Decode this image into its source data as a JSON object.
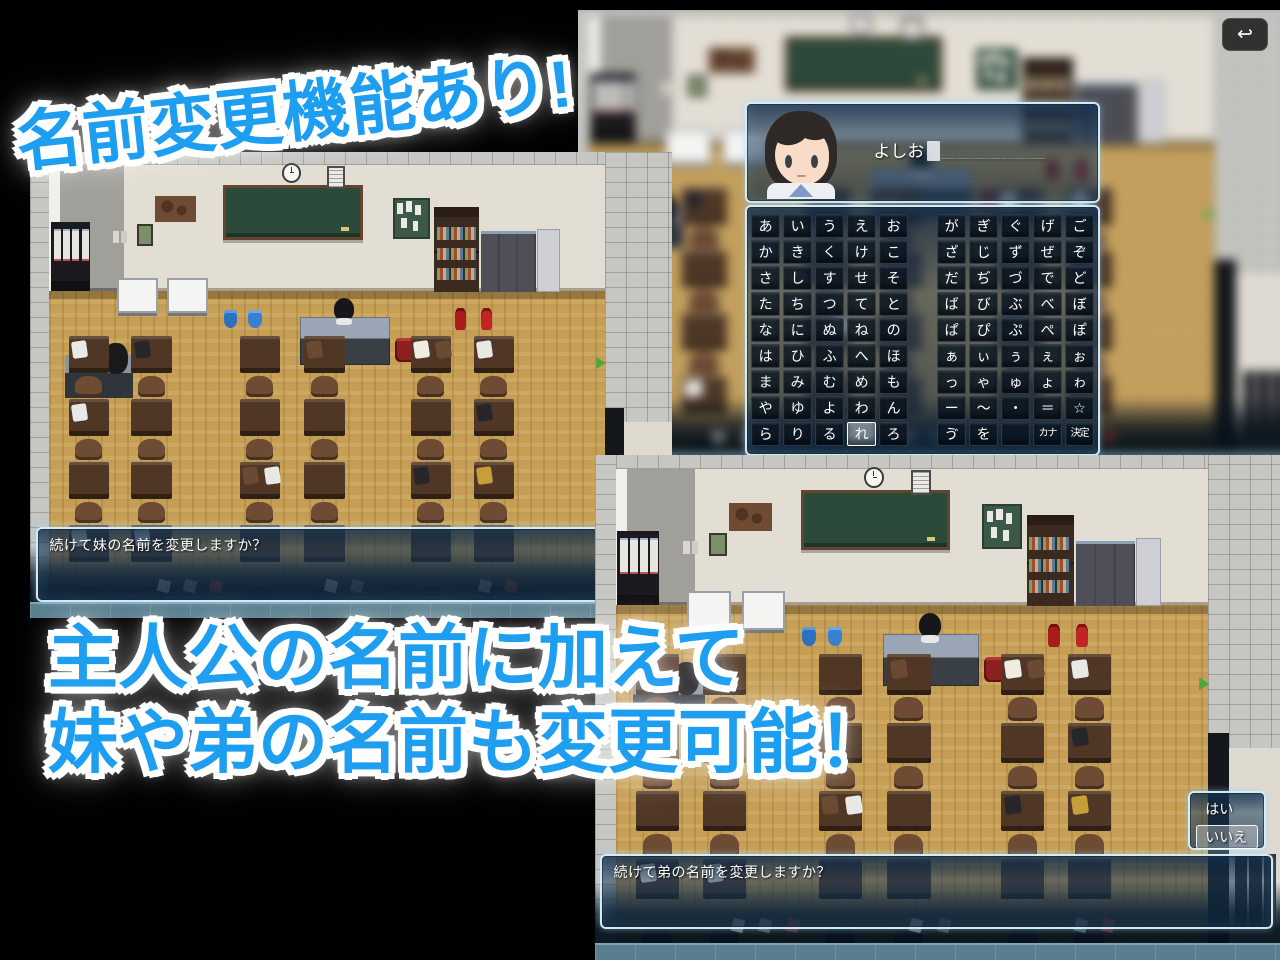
{
  "headlines": {
    "top": "名前変更機能あり!",
    "mid_line1": "主人公の名前に加えて",
    "mid_line2": "妹や弟の名前も変更可能！"
  },
  "name_input": {
    "value": "よしお",
    "empty_slots": "＿＿＿＿＿＿＿"
  },
  "keyboard": {
    "rows": [
      [
        "あ",
        "い",
        "う",
        "え",
        "お",
        "が",
        "ぎ",
        "ぐ",
        "げ",
        "ご"
      ],
      [
        "か",
        "き",
        "く",
        "け",
        "こ",
        "ざ",
        "じ",
        "ず",
        "ぜ",
        "ぞ"
      ],
      [
        "さ",
        "し",
        "す",
        "せ",
        "そ",
        "だ",
        "ぢ",
        "づ",
        "で",
        "ど"
      ],
      [
        "た",
        "ち",
        "つ",
        "て",
        "と",
        "ば",
        "び",
        "ぶ",
        "べ",
        "ぼ"
      ],
      [
        "な",
        "に",
        "ぬ",
        "ね",
        "の",
        "ぱ",
        "ぴ",
        "ぷ",
        "ぺ",
        "ぽ"
      ],
      [
        "は",
        "ひ",
        "ふ",
        "へ",
        "ほ",
        "ぁ",
        "ぃ",
        "ぅ",
        "ぇ",
        "ぉ"
      ],
      [
        "ま",
        "み",
        "む",
        "め",
        "も",
        "っ",
        "ゃ",
        "ゅ",
        "ょ",
        "ゎ"
      ],
      [
        "や",
        "ゆ",
        "よ",
        "わ",
        "ん",
        "ー",
        "～",
        "・",
        "＝",
        "☆"
      ],
      [
        "ら",
        "り",
        "る",
        "れ",
        "ろ",
        "ゔ",
        "を",
        "",
        "カナ",
        "決定"
      ]
    ],
    "highlighted_key": "れ"
  },
  "dialogs": {
    "sister": "続けて妹の名前を変更しますか？",
    "brother": "続けて弟の名前を変更しますか？"
  },
  "choices": {
    "options": [
      "はい",
      "いいえ"
    ],
    "selected_index": 1
  },
  "icons": {
    "back": "↩"
  },
  "colors": {
    "accent_blue": "#1e9ef0",
    "window_border": "#cdebfa",
    "floor_wood": "#c79f54",
    "wall_cream": "#e3ded3",
    "blackboard_green": "#2c4a3a"
  }
}
